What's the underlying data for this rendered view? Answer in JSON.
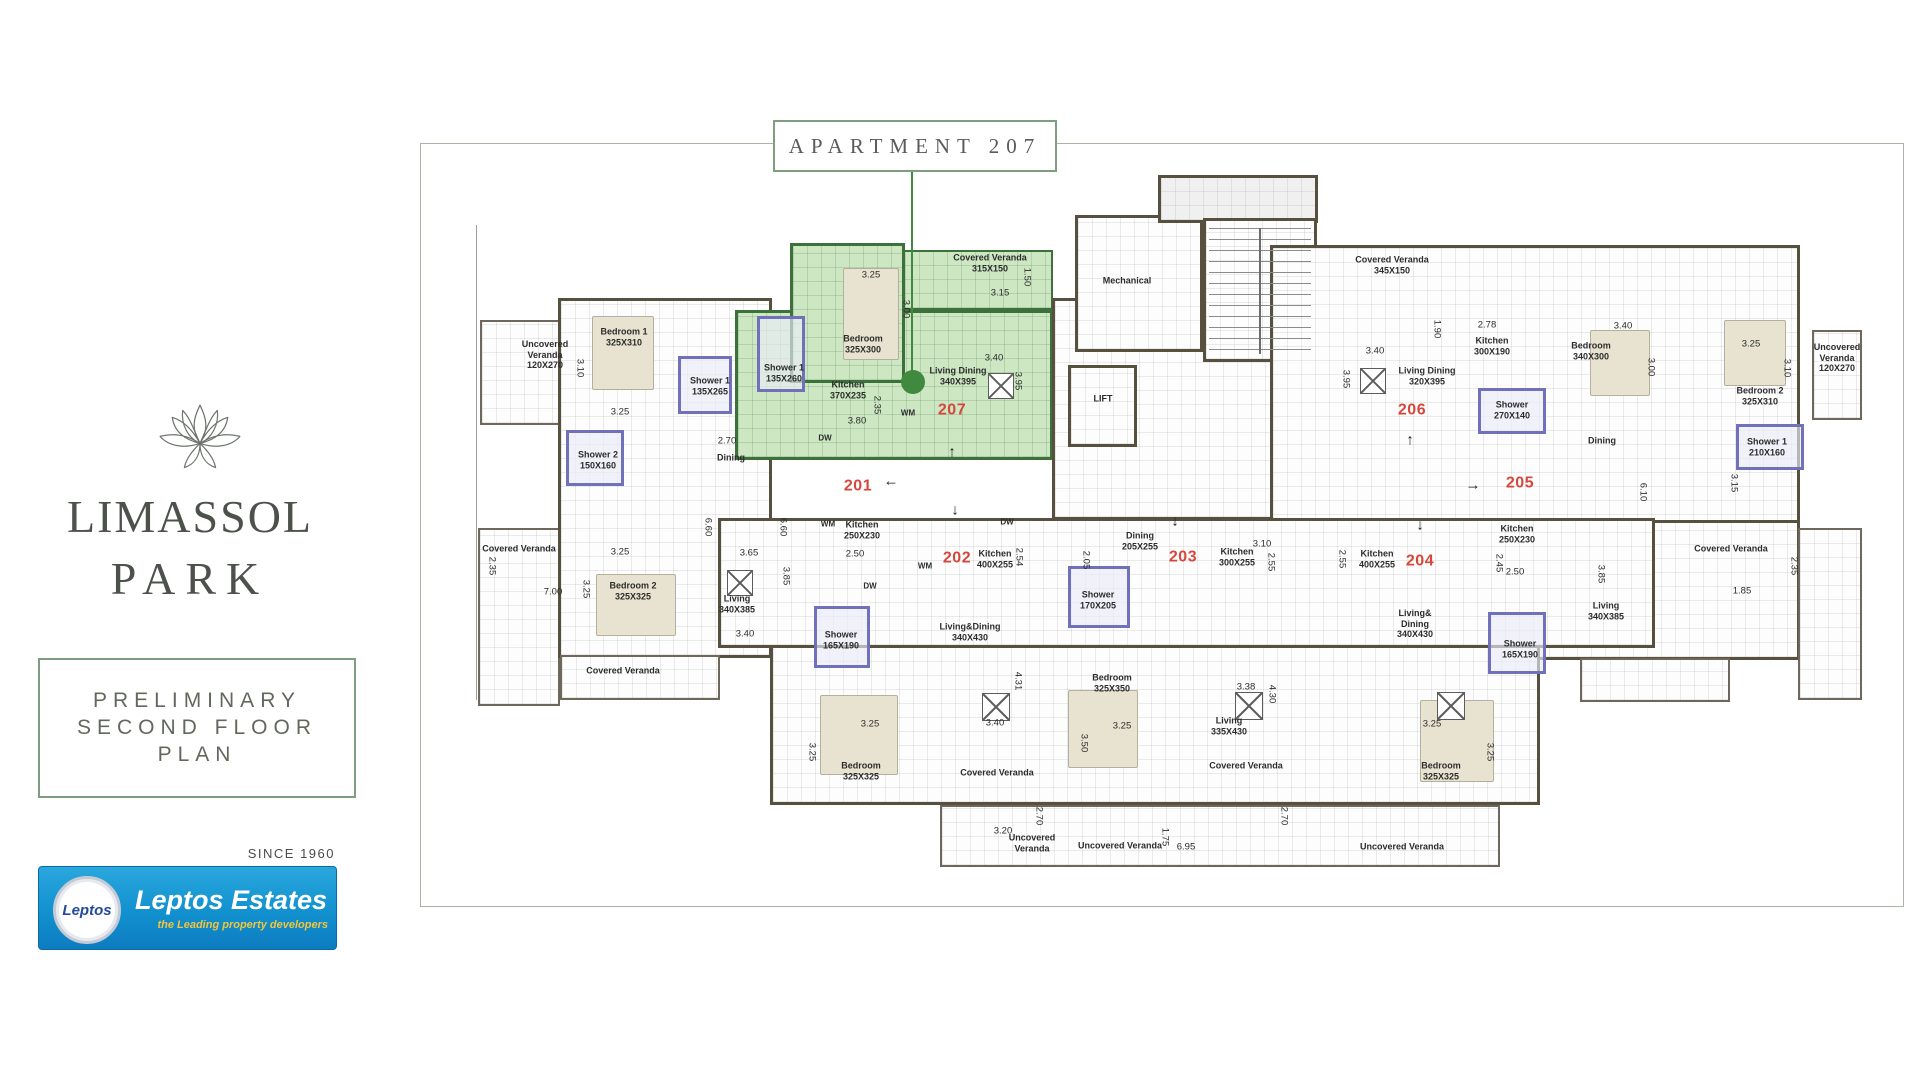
{
  "sidebar": {
    "brand": {
      "line1": "LIMASSOL",
      "line2": "PARK"
    },
    "plan_box": {
      "line1": "PRELIMINARY",
      "line2": "SECOND FLOOR",
      "line3": "PLAN"
    },
    "since_label": "SINCE 1960",
    "leptos": {
      "badge": "Leptos",
      "name": "Leptos Estates",
      "tagline": "the Leading property developers"
    }
  },
  "colors": {
    "box_green": "#7f9e7f",
    "plan_border": "#aab4a6",
    "highlight_fill": "#cde7c2",
    "highlight_wall": "#3c713c",
    "leader_green": "#3f8a3f",
    "apartment_number_red": "#d6473b"
  },
  "plan": {
    "callout_label": "APARTMENT 207",
    "labels": [
      {
        "t": "Covered Veranda\n315X150",
        "x": 990,
        "y": 263,
        "k": "room"
      },
      {
        "t": "3.15",
        "x": 1000,
        "y": 293,
        "k": "dim"
      },
      {
        "t": "1.50",
        "x": 1027,
        "y": 277,
        "k": "vdim"
      },
      {
        "t": "3.25",
        "x": 871,
        "y": 275,
        "k": "dim"
      },
      {
        "t": "Bedroom\n325X300",
        "x": 863,
        "y": 344,
        "k": "room"
      },
      {
        "t": "3.00",
        "x": 906,
        "y": 309,
        "k": "vdim"
      },
      {
        "t": "Shower 1\n135X260",
        "x": 784,
        "y": 373,
        "k": "room"
      },
      {
        "t": "Kitchen\n370X235",
        "x": 848,
        "y": 390,
        "k": "room"
      },
      {
        "t": "Living Dining\n340X395",
        "x": 958,
        "y": 376,
        "k": "room"
      },
      {
        "t": "3.40",
        "x": 994,
        "y": 358,
        "k": "dim"
      },
      {
        "t": "3.95",
        "x": 1018,
        "y": 381,
        "k": "vdim"
      },
      {
        "t": "3.80",
        "x": 857,
        "y": 421,
        "k": "dim"
      },
      {
        "t": "2.35",
        "x": 877,
        "y": 405,
        "k": "vdim"
      },
      {
        "t": "WM",
        "x": 908,
        "y": 413,
        "k": "small"
      },
      {
        "t": "DW",
        "x": 825,
        "y": 438,
        "k": "small"
      },
      {
        "t": "207",
        "x": 952,
        "y": 411,
        "k": "apt"
      },
      {
        "t": "Uncovered\nVeranda\n120X270",
        "x": 545,
        "y": 355,
        "k": "room"
      },
      {
        "t": "Bedroom 1\n325X310",
        "x": 624,
        "y": 337,
        "k": "room"
      },
      {
        "t": "3.10",
        "x": 580,
        "y": 368,
        "k": "vdim"
      },
      {
        "t": "3.25",
        "x": 620,
        "y": 412,
        "k": "dim"
      },
      {
        "t": "Shower 2\n150X160",
        "x": 598,
        "y": 460,
        "k": "room"
      },
      {
        "t": "Shower 1\n135X265",
        "x": 710,
        "y": 386,
        "k": "room"
      },
      {
        "t": "2.70",
        "x": 727,
        "y": 441,
        "k": "dim"
      },
      {
        "t": "Dining",
        "x": 731,
        "y": 458,
        "k": "room"
      },
      {
        "t": "6.60",
        "x": 708,
        "y": 527,
        "k": "vdim"
      },
      {
        "t": "6.60",
        "x": 783,
        "y": 527,
        "k": "vdim"
      },
      {
        "t": "3.65",
        "x": 749,
        "y": 553,
        "k": "dim"
      },
      {
        "t": "Living\n340X385",
        "x": 737,
        "y": 604,
        "k": "room"
      },
      {
        "t": "3.40",
        "x": 745,
        "y": 634,
        "k": "dim"
      },
      {
        "t": "3.85",
        "x": 786,
        "y": 576,
        "k": "vdim"
      },
      {
        "t": "Bedroom 2\n325X325",
        "x": 633,
        "y": 591,
        "k": "room"
      },
      {
        "t": "3.25",
        "x": 586,
        "y": 589,
        "k": "vdim"
      },
      {
        "t": "3.25",
        "x": 620,
        "y": 552,
        "k": "dim"
      },
      {
        "t": "Covered Veranda",
        "x": 623,
        "y": 671,
        "k": "room"
      },
      {
        "t": "Covered Veranda",
        "x": 519,
        "y": 549,
        "k": "room"
      },
      {
        "t": "7.00",
        "x": 553,
        "y": 592,
        "k": "dim"
      },
      {
        "t": "2.35",
        "x": 492,
        "y": 566,
        "k": "vdim"
      },
      {
        "t": "201",
        "x": 858,
        "y": 487,
        "k": "apt"
      },
      {
        "t": "Mechanical",
        "x": 1127,
        "y": 281,
        "k": "room"
      },
      {
        "t": "LIFT",
        "x": 1103,
        "y": 399,
        "k": "room"
      },
      {
        "t": "Covered Veranda\n345X150",
        "x": 1392,
        "y": 265,
        "k": "room"
      },
      {
        "t": "Living Dining\n320X395",
        "x": 1427,
        "y": 376,
        "k": "room"
      },
      {
        "t": "3.40",
        "x": 1375,
        "y": 351,
        "k": "dim"
      },
      {
        "t": "3.95",
        "x": 1346,
        "y": 379,
        "k": "vdim"
      },
      {
        "t": "Kitchen\n300X190",
        "x": 1492,
        "y": 346,
        "k": "room"
      },
      {
        "t": "2.78",
        "x": 1487,
        "y": 325,
        "k": "dim"
      },
      {
        "t": "1.90",
        "x": 1437,
        "y": 329,
        "k": "vdim"
      },
      {
        "t": "206",
        "x": 1412,
        "y": 411,
        "k": "apt"
      },
      {
        "t": "Shower\n270X140",
        "x": 1512,
        "y": 410,
        "k": "room"
      },
      {
        "t": "Bedroom\n340X300",
        "x": 1591,
        "y": 351,
        "k": "room"
      },
      {
        "t": "3.40",
        "x": 1623,
        "y": 326,
        "k": "dim"
      },
      {
        "t": "3.00",
        "x": 1651,
        "y": 367,
        "k": "vdim"
      },
      {
        "t": "Bedroom 2\n325X310",
        "x": 1760,
        "y": 396,
        "k": "room"
      },
      {
        "t": "3.25",
        "x": 1751,
        "y": 344,
        "k": "dim"
      },
      {
        "t": "3.10",
        "x": 1787,
        "y": 368,
        "k": "vdim"
      },
      {
        "t": "Uncovered\nVeranda\n120X270",
        "x": 1837,
        "y": 358,
        "k": "room"
      },
      {
        "t": "Shower 1\n210X160",
        "x": 1767,
        "y": 447,
        "k": "room"
      },
      {
        "t": "Dining",
        "x": 1602,
        "y": 441,
        "k": "room"
      },
      {
        "t": "3.15",
        "x": 1734,
        "y": 483,
        "k": "vdim"
      },
      {
        "t": "6.10",
        "x": 1643,
        "y": 492,
        "k": "vdim"
      },
      {
        "t": "205",
        "x": 1520,
        "y": 484,
        "k": "apt"
      },
      {
        "t": "Kitchen\n250X230",
        "x": 1517,
        "y": 534,
        "k": "room"
      },
      {
        "t": "2.45",
        "x": 1499,
        "y": 563,
        "k": "vdim"
      },
      {
        "t": "2.50",
        "x": 1515,
        "y": 572,
        "k": "dim"
      },
      {
        "t": "Living\n340X385",
        "x": 1606,
        "y": 611,
        "k": "room"
      },
      {
        "t": "3.85",
        "x": 1601,
        "y": 574,
        "k": "vdim"
      },
      {
        "t": "Covered Veranda",
        "x": 1731,
        "y": 549,
        "k": "room"
      },
      {
        "t": "1.85",
        "x": 1742,
        "y": 591,
        "k": "dim"
      },
      {
        "t": "2.35",
        "x": 1794,
        "y": 566,
        "k": "vdim"
      },
      {
        "t": "202",
        "x": 957,
        "y": 559,
        "k": "apt"
      },
      {
        "t": "Kitchen\n400X255",
        "x": 995,
        "y": 559,
        "k": "room"
      },
      {
        "t": "2.54",
        "x": 1019,
        "y": 557,
        "k": "vdim"
      },
      {
        "t": "WM",
        "x": 925,
        "y": 566,
        "k": "small"
      },
      {
        "t": "DW",
        "x": 1007,
        "y": 522,
        "k": "small"
      },
      {
        "t": "Kitchen\n250X230",
        "x": 862,
        "y": 530,
        "k": "room"
      },
      {
        "t": "WM",
        "x": 828,
        "y": 524,
        "k": "small"
      },
      {
        "t": "2.50",
        "x": 855,
        "y": 554,
        "k": "dim"
      },
      {
        "t": "DW",
        "x": 870,
        "y": 586,
        "k": "small"
      },
      {
        "t": "Shower\n165X190",
        "x": 841,
        "y": 640,
        "k": "room"
      },
      {
        "t": "Living&Dining\n340X430",
        "x": 970,
        "y": 632,
        "k": "room"
      },
      {
        "t": "2.05",
        "x": 1086,
        "y": 560,
        "k": "vdim"
      },
      {
        "t": "Dining\n205X255",
        "x": 1140,
        "y": 541,
        "k": "room"
      },
      {
        "t": "203",
        "x": 1183,
        "y": 558,
        "k": "apt"
      },
      {
        "t": "Shower\n170X205",
        "x": 1098,
        "y": 600,
        "k": "room"
      },
      {
        "t": "Kitchen\n300X255",
        "x": 1237,
        "y": 557,
        "k": "room"
      },
      {
        "t": "3.10",
        "x": 1262,
        "y": 544,
        "k": "dim"
      },
      {
        "t": "2.55",
        "x": 1271,
        "y": 562,
        "k": "vdim"
      },
      {
        "t": "4.31",
        "x": 1018,
        "y": 681,
        "k": "vdim"
      },
      {
        "t": "3.40",
        "x": 995,
        "y": 723,
        "k": "dim"
      },
      {
        "t": "Bedroom\n325X325",
        "x": 861,
        "y": 771,
        "k": "room"
      },
      {
        "t": "3.25",
        "x": 870,
        "y": 724,
        "k": "dim"
      },
      {
        "t": "3.25",
        "x": 812,
        "y": 752,
        "k": "vdim"
      },
      {
        "t": "Covered Veranda",
        "x": 997,
        "y": 773,
        "k": "room"
      },
      {
        "t": "Bedroom\n325X350",
        "x": 1112,
        "y": 683,
        "k": "room"
      },
      {
        "t": "3.25",
        "x": 1122,
        "y": 726,
        "k": "dim"
      },
      {
        "t": "3.50",
        "x": 1084,
        "y": 743,
        "k": "vdim"
      },
      {
        "t": "Living\n335X430",
        "x": 1229,
        "y": 726,
        "k": "room"
      },
      {
        "t": "3.38",
        "x": 1246,
        "y": 687,
        "k": "dim"
      },
      {
        "t": "4.30",
        "x": 1272,
        "y": 694,
        "k": "vdim"
      },
      {
        "t": "Covered Veranda",
        "x": 1246,
        "y": 766,
        "k": "room"
      },
      {
        "t": "204",
        "x": 1420,
        "y": 562,
        "k": "apt"
      },
      {
        "t": "Kitchen\n400X255",
        "x": 1377,
        "y": 559,
        "k": "room"
      },
      {
        "t": "2.55",
        "x": 1342,
        "y": 559,
        "k": "vdim"
      },
      {
        "t": "Living&\nDining\n340X430",
        "x": 1415,
        "y": 624,
        "k": "room"
      },
      {
        "t": "Shower\n165X190",
        "x": 1520,
        "y": 649,
        "k": "room"
      },
      {
        "t": "Bedroom\n325X325",
        "x": 1441,
        "y": 771,
        "k": "room"
      },
      {
        "t": "3.25",
        "x": 1432,
        "y": 724,
        "k": "dim"
      },
      {
        "t": "3.25",
        "x": 1490,
        "y": 752,
        "k": "vdim"
      },
      {
        "t": "3.20",
        "x": 1003,
        "y": 831,
        "k": "dim"
      },
      {
        "t": "Uncovered\nVeranda",
        "x": 1032,
        "y": 843,
        "k": "room"
      },
      {
        "t": "Uncovered Veranda",
        "x": 1120,
        "y": 846,
        "k": "room"
      },
      {
        "t": "6.95",
        "x": 1186,
        "y": 847,
        "k": "dim"
      },
      {
        "t": "1.75",
        "x": 1165,
        "y": 837,
        "k": "vdim"
      },
      {
        "t": "2.70",
        "x": 1039,
        "y": 816,
        "k": "vdim"
      },
      {
        "t": "2.70",
        "x": 1284,
        "y": 816,
        "k": "vdim"
      },
      {
        "t": "Uncovered Veranda",
        "x": 1402,
        "y": 847,
        "k": "room"
      }
    ],
    "arrows": [
      {
        "g": "↑",
        "x": 952,
        "y": 452
      },
      {
        "g": "←",
        "x": 891,
        "y": 481
      },
      {
        "g": "↓",
        "x": 955,
        "y": 510
      },
      {
        "g": "↓",
        "x": 1175,
        "y": 521
      },
      {
        "g": "↓",
        "x": 1420,
        "y": 525
      },
      {
        "g": "→",
        "x": 1473,
        "y": 485
      },
      {
        "g": "↑",
        "x": 1410,
        "y": 440
      }
    ]
  }
}
